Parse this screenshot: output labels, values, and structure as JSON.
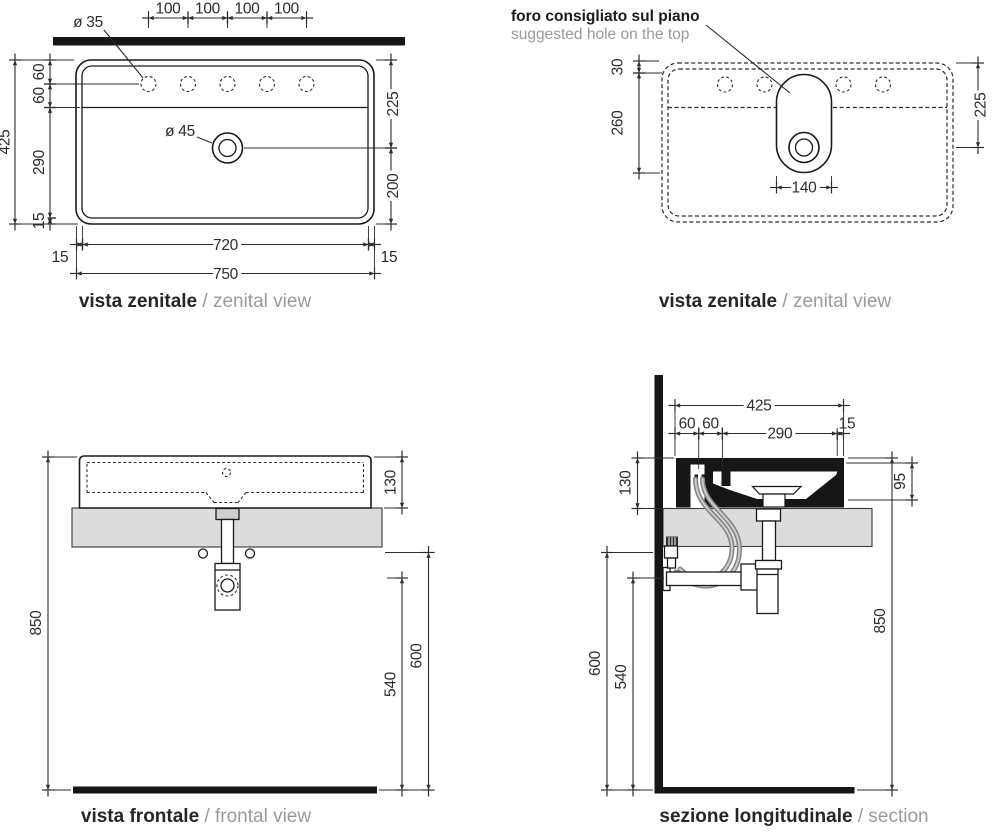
{
  "drawing": {
    "views": {
      "zenital_left": {
        "title": {
          "it": "vista zenitale",
          "sep": " / ",
          "en": "zenital view"
        },
        "labels": {
          "hole_dia": "ø 35",
          "drain_dia": "ø 45",
          "sp1": "100",
          "sp2": "100",
          "sp3": "100",
          "sp4": "100",
          "depth425": "425",
          "d60a": "60",
          "d60b": "60",
          "d290": "290",
          "d15": "15",
          "r225": "225",
          "r200": "200",
          "w720": "720",
          "b15l": "15",
          "b15r": "15",
          "w750": "750"
        }
      },
      "zenital_right": {
        "title": {
          "it": "vista zenitale",
          "sep": " / ",
          "en": "zenital view"
        },
        "note": {
          "it": "foro consigliato sul piano",
          "en": "suggested hole on the top"
        },
        "labels": {
          "t30": "30",
          "l260": "260",
          "r225": "225",
          "slot140": "140"
        }
      },
      "frontal": {
        "title": {
          "it": "vista frontale",
          "sep": " / ",
          "en": "frontal view"
        },
        "labels": {
          "h850": "850",
          "h130": "130",
          "h600": "600",
          "h540": "540"
        }
      },
      "section": {
        "title": {
          "it": "sezione longitudinale",
          "sep": " / ",
          "en": "section"
        },
        "labels": {
          "t425": "425",
          "t60a": "60",
          "t60b": "60",
          "t290": "290",
          "t15": "15",
          "l130": "130",
          "r95": "95",
          "r850": "850",
          "l600": "600",
          "l540": "540"
        }
      }
    },
    "colors": {
      "line": "#1a1a1a",
      "dim": "#2d2d2d",
      "muted": "#9a9a9a",
      "slab": "#dcdcdc",
      "hose": "#848484",
      "black_fill": "#161616"
    }
  }
}
